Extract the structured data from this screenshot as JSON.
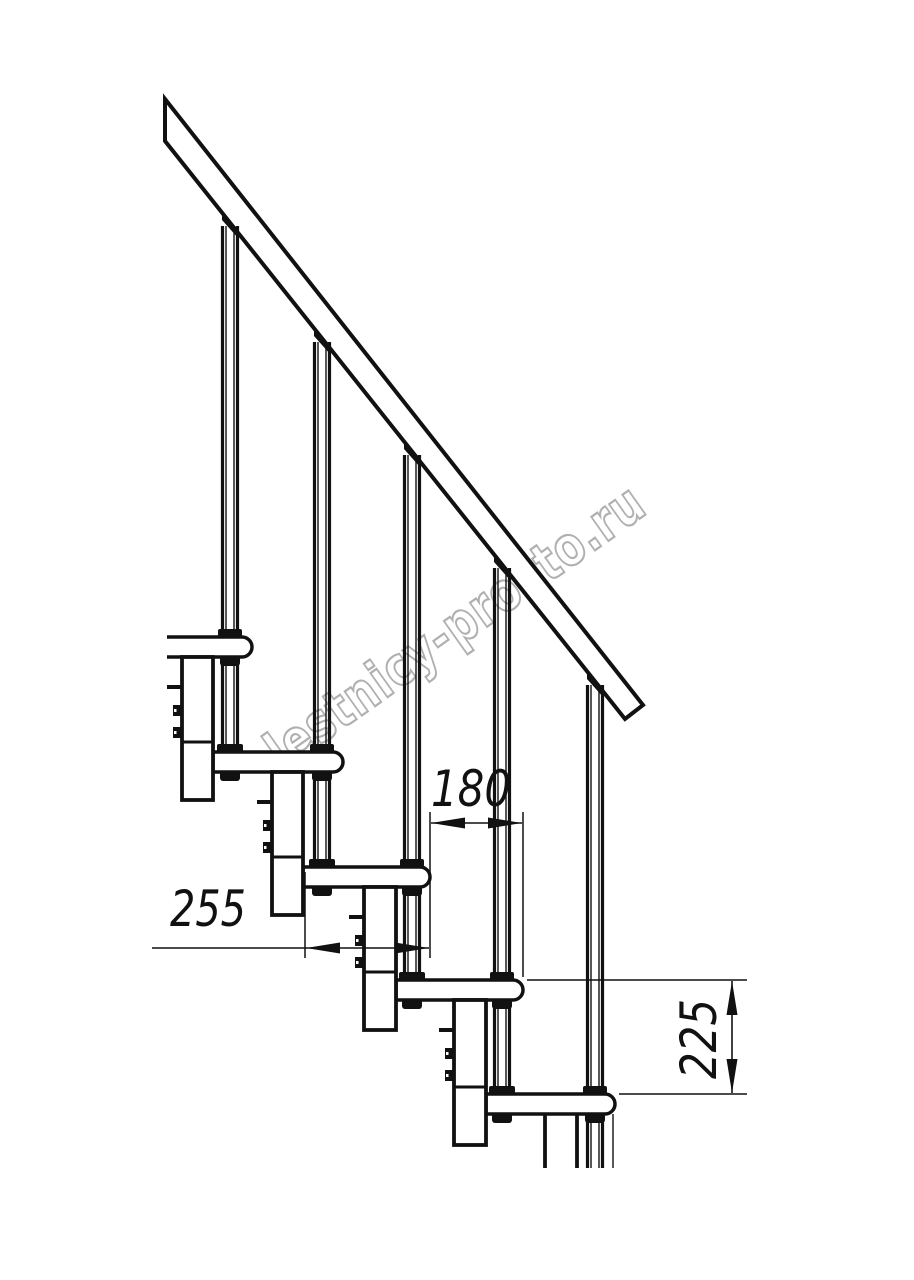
{
  "watermark": {
    "text": "lestnicy-prosto.ru",
    "color": "#b0b0b0"
  },
  "dimensions": {
    "run": {
      "label": "180"
    },
    "tread_depth": {
      "label": "255"
    },
    "rise": {
      "label": "225"
    }
  },
  "drawing": {
    "ink": "#111111",
    "rail": {
      "outline": "M165,99 L643,705 L625,719 L165,141 Z",
      "stroke": 4
    },
    "tubes": [
      {
        "cx": 230,
        "top": 212,
        "through": [
          {
            "t": 637,
            "b": 657
          }
        ],
        "base": {
          "t": 752,
          "b": 772
        }
      },
      {
        "cx": 322,
        "top": 328,
        "through": [
          {
            "t": 752,
            "b": 772
          }
        ],
        "base": {
          "t": 867,
          "b": 887
        }
      },
      {
        "cx": 412,
        "top": 441,
        "through": [
          {
            "t": 867,
            "b": 887
          }
        ],
        "base": {
          "t": 980,
          "b": 1000
        }
      },
      {
        "cx": 502,
        "top": 554,
        "through": [
          {
            "t": 980,
            "b": 1000
          }
        ],
        "base": {
          "t": 1094,
          "b": 1114
        }
      },
      {
        "cx": 595,
        "top": 671,
        "through": [
          {
            "t": 1094,
            "b": 1114
          }
        ],
        "end": 1168
      }
    ],
    "treads": [
      {
        "x": 167,
        "y": 637,
        "w": 85,
        "h": 20,
        "open_left": true
      },
      {
        "x": 213,
        "y": 752,
        "w": 130,
        "h": 20
      },
      {
        "x": 303,
        "y": 867,
        "w": 127,
        "h": 20
      },
      {
        "x": 396,
        "y": 980,
        "w": 127,
        "h": 20
      },
      {
        "x": 486,
        "y": 1094,
        "w": 129,
        "h": 20
      }
    ],
    "columns": [
      {
        "x": 182,
        "w": 31,
        "y": 657,
        "h": 143,
        "joint": 742,
        "tab": 687,
        "nubs": [
          705,
          727
        ]
      },
      {
        "x": 272,
        "w": 31,
        "y": 772,
        "h": 143,
        "joint": 857,
        "tab": 802,
        "nubs": [
          820,
          842
        ]
      },
      {
        "x": 364,
        "w": 32,
        "y": 887,
        "h": 143,
        "joint": 972,
        "tab": 917,
        "nubs": [
          935,
          957
        ]
      },
      {
        "x": 454,
        "w": 32,
        "y": 1000,
        "h": 145,
        "joint": 1087,
        "tab": 1030,
        "nubs": [
          1048,
          1070
        ]
      },
      {
        "x": 545,
        "w": 32,
        "y": 1114,
        "h": 54,
        "open_bottom": true
      }
    ],
    "extra_lines": [
      {
        "x1": 613,
        "y1": 1114,
        "x2": 613,
        "y2": 1168,
        "w": 1.4
      }
    ],
    "dims": {
      "ext_v": [
        {
          "x": 430,
          "y1": 812,
          "y2": 958
        },
        {
          "x": 523,
          "y1": 812,
          "y2": 977
        },
        {
          "x": 305,
          "y1": 872,
          "y2": 958
        }
      ],
      "ext_h": [
        {
          "y": 980,
          "x1": 527,
          "x2": 747
        },
        {
          "y": 1094,
          "x1": 619,
          "x2": 747
        }
      ],
      "lines": [
        {
          "x1": 431,
          "y1": 823,
          "x2": 522,
          "y2": 823
        },
        {
          "x1": 152,
          "y1": 948,
          "x2": 429,
          "y2": 948
        },
        {
          "x1": 732,
          "y1": 981,
          "x2": 732,
          "y2": 1093
        }
      ],
      "arrows": [
        {
          "x": 431,
          "y": 823,
          "dir": "left"
        },
        {
          "x": 522,
          "y": 823,
          "dir": "right"
        },
        {
          "x": 306,
          "y": 948,
          "dir": "left"
        },
        {
          "x": 429,
          "y": 948,
          "dir": "right"
        },
        {
          "x": 732,
          "y": 981,
          "dir": "up"
        },
        {
          "x": 732,
          "y": 1093,
          "dir": "down"
        }
      ]
    }
  }
}
